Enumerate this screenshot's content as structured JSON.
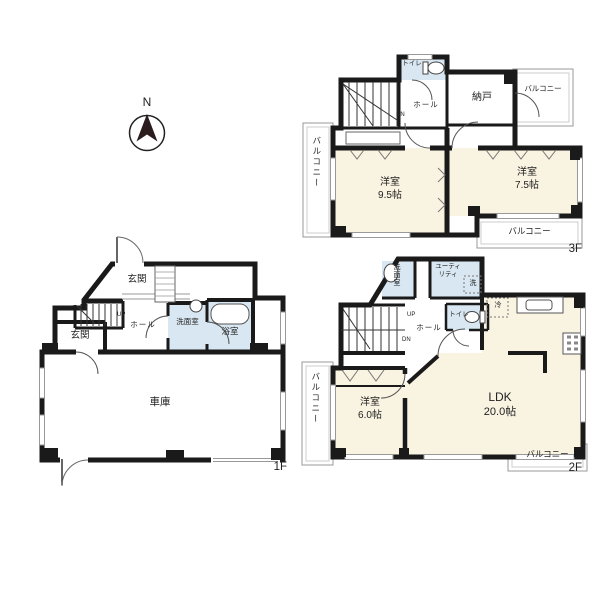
{
  "compass": {
    "north_label": "N"
  },
  "palette": {
    "wall": "#1a1a1a",
    "room_fill": "#f9f3e1",
    "wet_room_fill": "#d8e7f1",
    "balcony_line": "#999999"
  },
  "floor3": {
    "floor_label": "3F",
    "toilet": "トイレ",
    "hall": "ホール",
    "stairs_down": "DN",
    "storage": "納戸",
    "bedroom1_name": "洋室",
    "bedroom1_size": "9.5帖",
    "bedroom2_name": "洋室",
    "bedroom2_size": "7.5帖",
    "balcony_left": "バルコニー",
    "balcony_top_right": "バルコニー",
    "balcony_bottom": "バルコニー"
  },
  "floor2": {
    "floor_label": "2F",
    "washroom": "洗面室",
    "utility_line1": "ユーティ",
    "utility_line2": "リティ",
    "washer": "洗",
    "toilet": "トイレ",
    "hall": "ホール",
    "stairs_up": "UP",
    "stairs_down": "DN",
    "fridge": "冷",
    "ldk_name": "LDK",
    "ldk_size": "20.0帖",
    "bedroom_name": "洋室",
    "bedroom_size": "6.0帖",
    "balcony_left": "バルコニー",
    "balcony_bottom": "バルコニー"
  },
  "floor1": {
    "floor_label": "1F",
    "entrance_upper": "玄関",
    "entrance_lower": "玄関",
    "hall": "ホール",
    "stairs_up": "UP",
    "washroom": "洗面室",
    "bathroom": "浴室",
    "garage": "車庫"
  }
}
